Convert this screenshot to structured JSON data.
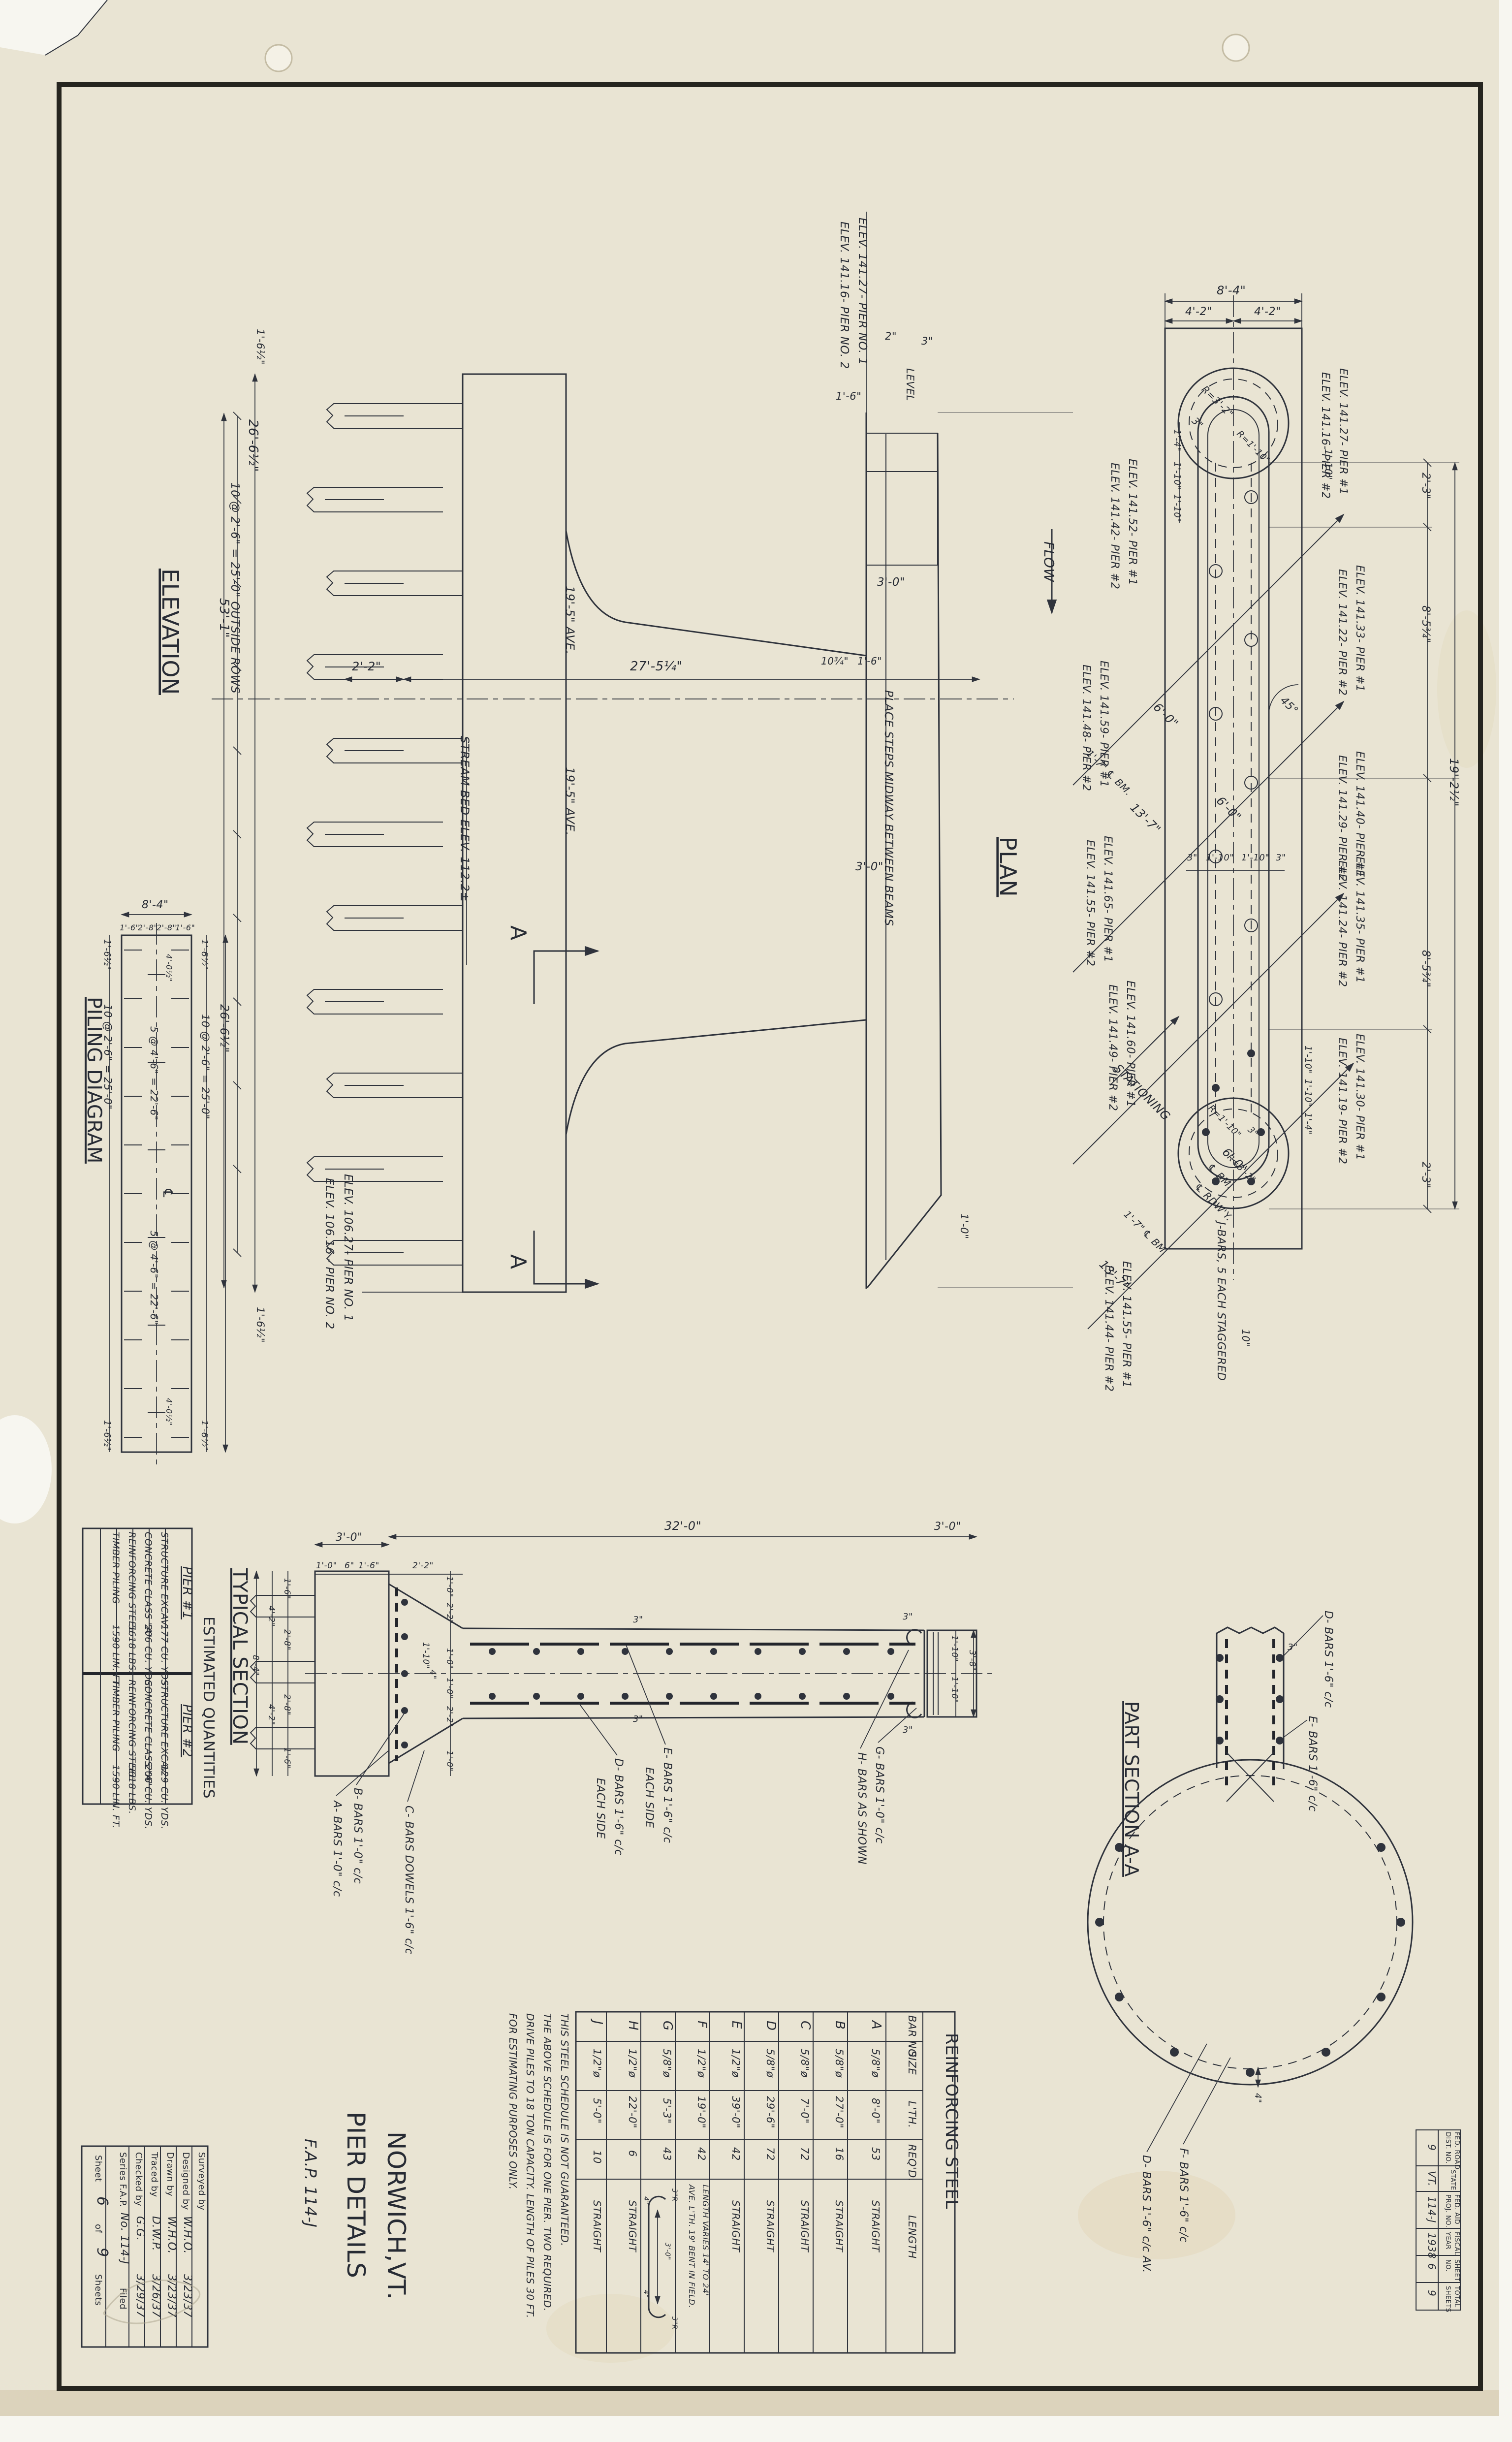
{
  "sheet": {
    "title1": "PIER DETAILS",
    "title2": "NORWICH,VT.",
    "title3": "F.A.P. 114-J"
  },
  "stamp": {
    "rows": [
      {
        "l1": "FED. ROAD",
        "l2": "DIST. NO.",
        "v": "9"
      },
      {
        "l1": "STATE",
        "l2": "",
        "v": "VT."
      },
      {
        "l1": "FED. AID",
        "l2": "PROJ. NO.",
        "v": "114-J"
      },
      {
        "l1": "FISCAL",
        "l2": "YEAR",
        "v": "1938"
      },
      {
        "l1": "SHEET",
        "l2": "NO.",
        "v": "6"
      },
      {
        "l1": "TOTAL",
        "l2": "SHEETS",
        "v": "9"
      }
    ]
  },
  "titleblock": {
    "rows": [
      {
        "l": "Surveyed by",
        "v": "",
        "d": ""
      },
      {
        "l": "Designed by",
        "v": "W.H.O.",
        "d": "3/23/37"
      },
      {
        "l": "Drawn by",
        "v": "W.H.O.",
        "d": "3/23/37"
      },
      {
        "l": "Traced by",
        "v": "D.W.P.",
        "d": "3/26/37"
      },
      {
        "l": "Checked by",
        "v": "G.G.",
        "d": "3/29/37"
      }
    ],
    "series_label": "Series F.A.P.",
    "series_no": "No. 114-J",
    "filed": "Filed",
    "sheet_word": "Sheet",
    "sheet_no": "6",
    "of_word": "of",
    "total_no": "9",
    "sheets_word": "Sheets"
  },
  "elevation": {
    "title": "ELEVATION",
    "oal": "53'-1\"",
    "footing_len": "26'-6½\"",
    "pile_rows": "10 @ 2'-6\" = 25'-0\" OUTSIDE ROWS",
    "end_top": "1'-6½\"",
    "end_bot": "1'-6½\"",
    "d22": "2'-2\"",
    "d2754": "27'-5¼\"",
    "h195a": "19'-5\" AVE.",
    "h195b": "19'-5\" AVE.",
    "stream": "STREAM BED ELEV. 112.2±",
    "cut1": "ELEV. 106.27- PIER NO. 1",
    "cut2": "ELEV. 106.16 - PIER NO. 2",
    "top1": "ELEV. 141.27- PIER NO. 1",
    "top2": "ELEV. 141.16- PIER NO. 2",
    "d16": "1'-6\"",
    "d2": "2\"",
    "d3": "3\"",
    "level": "LEVEL",
    "d30": "3'-0\"",
    "d10": "1'-0\"",
    "d1034": "10¾\"",
    "d16b": "1'-6\"",
    "d30b": "3'-0\"",
    "steps": "PLACE STEPS MIDWAY BETWEEN BEAMS",
    "secA1": "A",
    "secA2": "A"
  },
  "piling": {
    "title": "PILING DIAGRAM",
    "w": "8'-4\"",
    "s1": "1'-6\"",
    "s2": "2'-8\"",
    "s3": "2'-8\"",
    "s4": "1'-6\"",
    "e1": "1'-6½\"",
    "e2": "1'-6½\"",
    "e3": "1'-6½\"",
    "e4": "1'-6½\"",
    "rowL": "10 @ 2'-6\" = 25'-0\"",
    "rowR": "10 @ 2'-6\" = 25'-0\"",
    "midA": "5 @ 4'-6\" = 22'-6\"",
    "midB": "5 @ 4'-6\" = 22'-6\"",
    "off1": "4'-0½\"",
    "off2": "4'-0½\"",
    "oal": "26'-6½\"",
    "cl": "℄"
  },
  "plan": {
    "title": "PLAN",
    "flow": "FLOW",
    "stationing": "STATIONING",
    "w84": "8'-4\"",
    "w42a": "4'-2\"",
    "w42b": "4'-2\"",
    "r32a": "R=3'-2\"",
    "r110a": "R=1'-10\"",
    "c3a": "3\"",
    "ch14a": "1'-4\"",
    "ch110a": "1'-10\"",
    "ch110b": "1'-10\"",
    "right110": "1'-10\"",
    "rc23a": "2'-3\"",
    "rc85a": "8'-5¾\"",
    "rc85b": "8'-5¾\"",
    "rc23b": "2'-3\"",
    "oal": "19'-2½\"",
    "x3a": "3\"",
    "x110a": "1'-10\"",
    "x110b": "1'-10\"",
    "x3b": "3\"",
    "ang": "45°",
    "d60a": "6'-0\"",
    "d60b": "6'-0\"",
    "d60c": "6'-0\"",
    "d137a": "13'-7\"",
    "d137b": "13'-7\"",
    "d17a": "1'-7\"",
    "d17b": "1'-7\"",
    "clbm1": "℄ BM.",
    "clbm2": "℄ BM.",
    "clbm3": "℄ BM.",
    "clrdwy": "℄ RDW'Y.",
    "bc110a": "1'-10\"",
    "bc110b": "1'-10\"",
    "bc14": "1'-4\"",
    "br110": "R=1'-10\"",
    "br32": "R=3'-2\"",
    "bc3": "3\"",
    "jbars": "J-BARS, 5 EACH STAGGERED",
    "d10in": "10\"",
    "p1a": "ELEV. 141.52- PIER #1",
    "p1b": "ELEV. 141.42- PIER #2",
    "p2a": "ELEV. 141.59- PIER #1",
    "p2b": "ELEV. 141.48- PIER #2",
    "p3a": "ELEV. 141.65- PIER #1",
    "p3b": "ELEV. 141.55- PIER #2",
    "p4a": "ELEV. 141.60- PIER #1",
    "p4b": "ELEV. 141.49- PIER #2",
    "p5a": "ELEV. 141.55- PIER #1",
    "p5b": "ELEV. 141.44- PIER #2",
    "pAa": "ELEV. 141.27- PIER #1",
    "pAb": "ELEV. 141.16- PIER #2",
    "pBa": "ELEV. 141.33- PIER #1",
    "pBb": "ELEV. 141.22- PIER #2",
    "pCa": "ELEV. 141.40- PIER #1",
    "pCb": "ELEV. 141.29- PIER #2",
    "pDa": "ELEV. 141.35- PIER #1",
    "pDb": "ELEV. 141.24- PIER #2",
    "pEa": "ELEV. 141.30- PIER #1",
    "pEb": "ELEV. 141.19- PIER #2"
  },
  "typ": {
    "title": "TYPICAL SECTION",
    "top30a": "3'-0\"",
    "top320": "32'-0\"",
    "top30b": "3'-0\"",
    "c10": "1'-0\"",
    "c6": "6\"",
    "c16": "1'-6\"",
    "c22": "2'-2\"",
    "lv16a": "1'-6\"",
    "lv28a": "2'-8\"",
    "lv28b": "2'-8\"",
    "lv16b": "1'-6\"",
    "lv42a": "4'-2\"",
    "lv42b": "4'-2\"",
    "lv84": "8'-4\"",
    "rv10a": "1'-0\"",
    "rv22a": "2'-2\"",
    "rv10b": "1'-0\"",
    "rv10c": "1'-0\"",
    "rv22b": "2'-2\"",
    "rv10d": "1'-0\"",
    "rv110": "1'-10\"",
    "rv4": "4\"",
    "cov3a": "3\"",
    "cov3b": "3\"",
    "e3a": "3\"",
    "e3b": "3\"",
    "e110a": "1'-10\"",
    "e110b": "1'-10\"",
    "e38": "3'-8\"",
    "abars": "A- BARS 1'-0\" c/c",
    "bbars": "B- BARS 1'-0\" c/c",
    "cbars": "C- BARS DOWELS 1'-6\" c/c",
    "dbars": "D- BARS 1'-6\" c/c",
    "dbars2": "EACH SIDE",
    "ebars": "E- BARS 1'-6\" c/c",
    "ebars2": "EACH SIDE",
    "gbars": "G- BARS 1'-0\" c/c",
    "hbars": "H- BARS AS SHOWN"
  },
  "part": {
    "title": "PART SECTION A-A",
    "dbars": "D- BARS 1'-6\" c/c",
    "ebars": "E- BARS 1'-6\" c/c",
    "fbars": "F- BARS 1'-6\" c/c",
    "dbars2": "D- BARS 1'-6\" c/c AV.",
    "c3": "3\"",
    "c4": "4\""
  },
  "est": {
    "heading": "ESTIMATED QUANTITIES",
    "p1": "PIER #1",
    "p2": "PIER #2",
    "rows1": [
      {
        "n": "STRUCTURE EXCAV.",
        "v": "177 CU. YDS."
      },
      {
        "n": "CONCRETE CLASS \"A\"",
        "v": "206 CU. YDS."
      },
      {
        "n": "REINFORCING STEEL",
        "v": "5618 LBS."
      },
      {
        "n": "TIMBER PILING",
        "v": "1590 LIN. FT."
      }
    ],
    "rows2": [
      {
        "n": "STRUCTURE EXCAV.",
        "v": "129 CU. YDS."
      },
      {
        "n": "CONCRETE CLASS \"A\"",
        "v": "206 CU. YDS."
      },
      {
        "n": "REINFORCING STEEL",
        "v": "5618 LBS."
      },
      {
        "n": "TIMBER PILING",
        "v": "1590 LIN. FT."
      }
    ]
  },
  "steel": {
    "title": "REINFORCING STEEL",
    "h_bar": "BAR NO.",
    "h_size": "SIZE",
    "h_lth": "L'TH.",
    "h_req": "REQ'D.",
    "h_len": "LENGTH",
    "rows": [
      {
        "bar": "A",
        "size": "5/8\"ø",
        "lth": "8'-0\"",
        "req": "53",
        "len": "STRAIGHT"
      },
      {
        "bar": "B",
        "size": "5/8\"ø",
        "lth": "27'-0\"",
        "req": "16",
        "len": "STRAIGHT"
      },
      {
        "bar": "C",
        "size": "5/8\"ø",
        "lth": "7'-0\"",
        "req": "72",
        "len": "STRAIGHT"
      },
      {
        "bar": "D",
        "size": "5/8\"ø",
        "lth": "29'-6\"",
        "req": "72",
        "len": "STRAIGHT"
      },
      {
        "bar": "E",
        "size": "1/2\"ø",
        "lth": "39'-0\"",
        "req": "42",
        "len": "STRAIGHT"
      },
      {
        "bar": "F",
        "size": "1/2\"ø",
        "lth": "19'-0\"",
        "req": "42",
        "len": ""
      },
      {
        "bar": "G",
        "size": "5/8\"ø",
        "lth": "5'-3\"",
        "req": "43",
        "len": ""
      },
      {
        "bar": "H",
        "size": "1/2\"ø",
        "lth": "22'-0\"",
        "req": "6",
        "len": "STRAIGHT"
      },
      {
        "bar": "J",
        "size": "1/2\"ø",
        "lth": "5'-0\"",
        "req": "10",
        "len": "STRAIGHT"
      }
    ],
    "f1": "LENGTH VARIES 14' TO 24'",
    "f2": "AVE. L'TH. 19' BENT IN FIELD.",
    "g1": "3\"R",
    "g2": "4\"",
    "g3": "3'-0\"",
    "g4": "4\"",
    "g5": "3\"R",
    "notes": [
      "THIS STEEL SCHEDULE IS NOT GUARANTEED.",
      "THE ABOVE SCHEDULE IS FOR ONE PIER. TWO REQUIRED.",
      "DRIVE PILES TO 18 TON CAPACITY. LENGTH OF PILES 30 FT.",
      "FOR ESTIMATING PURPOSES ONLY."
    ]
  }
}
